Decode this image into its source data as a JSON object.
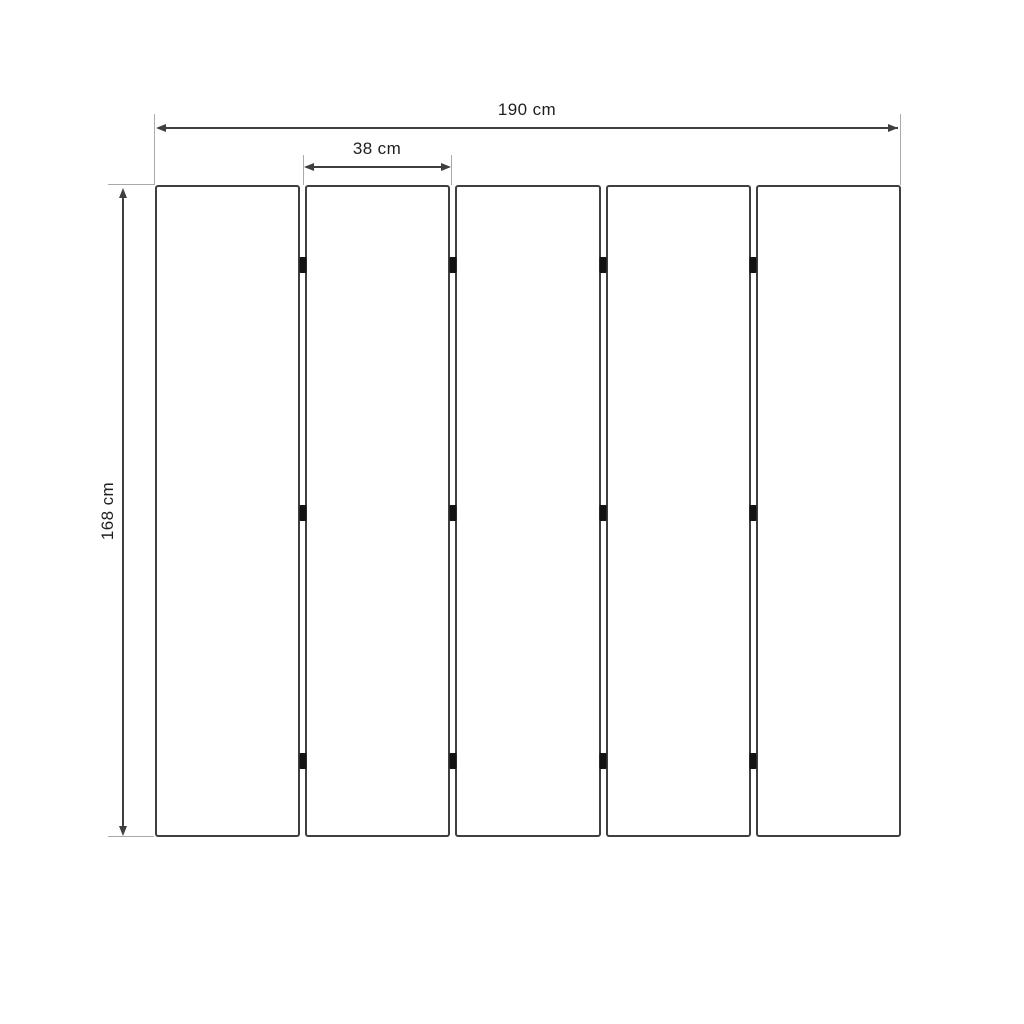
{
  "diagram": {
    "type": "dimension-drawing",
    "subject": "five-panel folding screen, front elevation",
    "labels": {
      "total_width": "190 cm",
      "panel_width": "38 cm",
      "height": "168 cm"
    },
    "panels": {
      "count": 5,
      "gap_px": 5,
      "hinges_per_gap": 3,
      "hinge_positions_pct": [
        12.3,
        50.3,
        88.3
      ]
    },
    "colors": {
      "background": "#ffffff",
      "panel_border": "#3f3f3f",
      "dimension_line": "#3f3f3f",
      "extension_line": "#a9a9a9",
      "hinge": "#121212",
      "text": "#1f1f1f"
    }
  }
}
